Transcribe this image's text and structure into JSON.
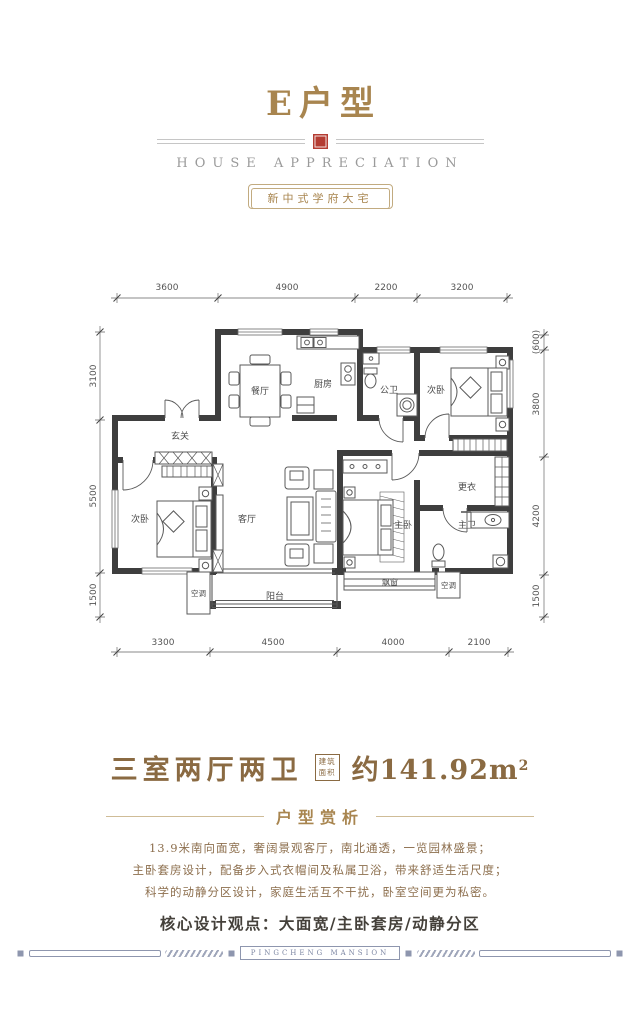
{
  "header": {
    "title": "E户型",
    "subtitle": "HOUSE APPRECIATION",
    "badge": "新中式学府大宅"
  },
  "colors": {
    "gold": "#a8854f",
    "seal_red": "#b43c32",
    "wall": "#3e3e3e",
    "footer_blue": "#8e96ae"
  },
  "plan": {
    "dims": {
      "top": [
        "3600",
        "4900",
        "2200",
        "3200"
      ],
      "bottom": [
        "3300",
        "4500",
        "4000",
        "2100"
      ],
      "left": [
        "3100",
        "5500",
        "1500"
      ],
      "right": [
        "(600)",
        "3800",
        "4200",
        "1500"
      ]
    },
    "rooms": {
      "dining": "餐厅",
      "kitchen": "厨房",
      "guest_bath": "公卫",
      "bedroom_right": "次卧",
      "foyer": "玄关",
      "bedroom_left": "次卧",
      "living": "客厅",
      "dressing": "更衣",
      "master": "主卧",
      "master_bath": "主卫",
      "balcony": "阳台",
      "bay_window": "飘窗",
      "ac_left": "空调",
      "ac_right": "空调"
    }
  },
  "summary": {
    "layout": "三室两厅两卫",
    "area_badge_line1": "建筑",
    "area_badge_line2": "面积",
    "area_value": "约141.92m",
    "area_sup": "2"
  },
  "analysis": {
    "heading": "户型赏析",
    "lines": [
      "13.9米南向面宽，奢阔景观客厅，南北通透，一览园林盛景；",
      "主卧套房设计，配备步入式衣帽间及私属卫浴，带来舒适生活尺度；",
      "科学的动静分区设计，家庭生活互不干扰，卧室空间更为私密。"
    ],
    "core": "核心设计观点：大面宽/主卧套房/动静分区"
  },
  "footer": {
    "brand": "PINGCHENG MANSION"
  }
}
